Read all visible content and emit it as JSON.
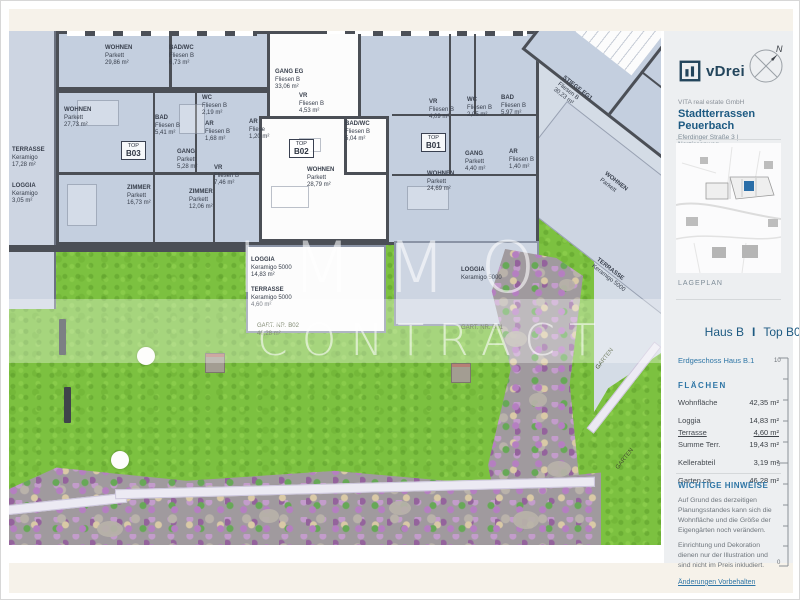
{
  "theme": {
    "accent": "#2f76a6",
    "title_blue": "#1d5a82",
    "wall": "#4b4f56",
    "room_fill": "#c4cfdf",
    "lawn_green": "#7cc140",
    "highlight_blue": "#2a6ea8"
  },
  "watermark": {
    "line1": "IMMO",
    "line2": "CONTRACT"
  },
  "sidebar": {
    "logo_text": "vDrei",
    "compass_letter": "N",
    "company": "VITA real estate GmbH",
    "project": "Stadtterrassen Peuerbach",
    "address": "Eferdinger Straße 3 | Narzissenweg",
    "siteplan_label": "LAGEPLAN",
    "unit_title_house": "Haus B",
    "unit_title_sep": "I",
    "unit_title_top": "Top B02",
    "unit_subtitle": "Erdgeschoss Haus B.1",
    "flaechen_title": "FLÄCHEN",
    "flaechen_rows": [
      {
        "label": "Wohnfläche",
        "value": "42,35 m²",
        "cls": "gap-after"
      },
      {
        "label": "Loggia",
        "value": "14,83 m²",
        "cls": ""
      },
      {
        "label": "Terrasse",
        "value": "4,60 m²",
        "cls": "sum-line"
      },
      {
        "label": "Summe Terr.",
        "value": "19,43 m²",
        "cls": "gap-after"
      },
      {
        "label": "Kellerabteil",
        "value": "3,19 m²",
        "cls": "gap-after"
      },
      {
        "label": "Garten ca.",
        "value": "46,28 m²",
        "cls": ""
      }
    ],
    "ruler_labels": {
      "top": "10",
      "mid": "5",
      "bottom": "0"
    },
    "hinweise_title": "WICHTIGE HINWEISE",
    "hinweise": [
      {
        "text": "Auf Grund des derzeitigen Planungsstandes kann sich die Wohnfläche und die Größe der Eigengärten noch verändern."
      },
      {
        "text": "Einrichtung und Dekoration dienen nur der Illustration und sind nicht im Preis inkludiert."
      }
    ],
    "footnote": "Änderungen Vorbehalten"
  },
  "plan": {
    "rooms": [
      {
        "x": 96,
        "y": 14,
        "lines": [
          "WOHNEN",
          "Parkett",
          "29,86 m²"
        ]
      },
      {
        "x": 160,
        "y": 14,
        "lines": [
          "BAD/WC",
          "Fliesen B",
          "6,73 m²"
        ]
      },
      {
        "x": 55,
        "y": 76,
        "lines": [
          "WOHNEN",
          "Parkett",
          "27,73 m²"
        ]
      },
      {
        "x": 146,
        "y": 84,
        "lines": [
          "BAD",
          "Fliesen B",
          "5,41 m²"
        ]
      },
      {
        "x": 193,
        "y": 64,
        "lines": [
          "WC",
          "Fliesen B",
          "2,19 m²"
        ]
      },
      {
        "x": 196,
        "y": 90,
        "lines": [
          "AR",
          "Fliesen B",
          "1,68 m²"
        ]
      },
      {
        "x": 168,
        "y": 118,
        "lines": [
          "GANG",
          "Parkett",
          "5,28 m²"
        ]
      },
      {
        "x": 205,
        "y": 134,
        "lines": [
          "VR",
          "Fliesen B",
          "7,46 m²"
        ]
      },
      {
        "x": 118,
        "y": 154,
        "lines": [
          "ZIMMER",
          "Parkett",
          "16,73 m²"
        ]
      },
      {
        "x": 180,
        "y": 158,
        "lines": [
          "ZIMMER",
          "Parkett",
          "12,06 m²"
        ]
      },
      {
        "x": 266,
        "y": 38,
        "lines": [
          "GANG EG",
          "Fliesen B",
          "33,06 m²"
        ]
      },
      {
        "x": 290,
        "y": 62,
        "lines": [
          "VR",
          "Fliesen B",
          "4,53 m²"
        ]
      },
      {
        "x": 336,
        "y": 90,
        "lines": [
          "BAD/WC",
          "Fliesen B",
          "5,04 m²"
        ]
      },
      {
        "x": 298,
        "y": 136,
        "lines": [
          "WOHNEN",
          "Parkett",
          "28,79 m²"
        ]
      },
      {
        "x": 240,
        "y": 88,
        "lines": [
          "AR",
          "Fliese",
          "1,20 m²"
        ]
      },
      {
        "x": 420,
        "y": 68,
        "lines": [
          "VR",
          "Fliesen B",
          "4,09 m²"
        ]
      },
      {
        "x": 458,
        "y": 66,
        "lines": [
          "WC",
          "Fliesen B",
          "2,05 m²"
        ]
      },
      {
        "x": 492,
        "y": 64,
        "lines": [
          "BAD",
          "Fliesen B",
          "5,97 m²"
        ]
      },
      {
        "x": 456,
        "y": 120,
        "lines": [
          "GANG",
          "Parkett",
          "4,40 m²"
        ]
      },
      {
        "x": 500,
        "y": 118,
        "lines": [
          "AR",
          "Fliesen B",
          "1,40 m²"
        ]
      },
      {
        "x": 418,
        "y": 140,
        "lines": [
          "WOHNEN",
          "Parkett",
          "24,69 m²"
        ]
      },
      {
        "x": 3,
        "y": 116,
        "lines": [
          "TERRASSE",
          "Keramigo",
          "17,28 m²"
        ]
      },
      {
        "x": 3,
        "y": 152,
        "lines": [
          "LOGGIA",
          "Keramigo",
          "3,05 m²"
        ]
      },
      {
        "x": 242,
        "y": 226,
        "lines": [
          "LOGGIA",
          "Keramigo 5000",
          "14,83 m²"
        ]
      },
      {
        "x": 242,
        "y": 256,
        "lines": [
          "TERRASSE",
          "Keramigo 5000",
          "4,60 m²"
        ]
      },
      {
        "x": 452,
        "y": 236,
        "lines": [
          "LOGGIA",
          "Keramigo 5000",
          ""
        ]
      },
      {
        "x": 556,
        "y": 44,
        "rot": 38,
        "lines": [
          "STIEGE EG1",
          "Fliesen B",
          "30,23 m²"
        ]
      },
      {
        "x": 598,
        "y": 140,
        "rot": 38,
        "lines": [
          "WOHNEN",
          "Parkett",
          ""
        ]
      },
      {
        "x": 590,
        "y": 226,
        "rot": 38,
        "lines": [
          "TERRASSE",
          "Keramigo 5000",
          ""
        ]
      }
    ],
    "top_badges": [
      {
        "x": 112,
        "y": 110,
        "t": "TOP",
        "b": "B03"
      },
      {
        "x": 280,
        "y": 108,
        "t": "TOP",
        "b": "B02"
      },
      {
        "x": 412,
        "y": 102,
        "t": "TOP",
        "b": "B01"
      }
    ],
    "garden_labels": [
      {
        "x": 248,
        "y": 292,
        "lines": [
          "GART. NR. B02",
          "46,28 m²",
          ""
        ]
      },
      {
        "x": 452,
        "y": 294,
        "lines": [
          "GART. NR. B01",
          "",
          ""
        ]
      },
      {
        "x": 586,
        "y": 336,
        "rot": -52,
        "lines": [
          "GARTEN",
          "",
          ""
        ]
      },
      {
        "x": 606,
        "y": 436,
        "rot": -52,
        "lines": [
          "GARTEN",
          "",
          ""
        ]
      }
    ],
    "discs": [
      {
        "x": 128,
        "y": 316
      },
      {
        "x": 102,
        "y": 420
      }
    ],
    "plaques": [
      {
        "x": 196,
        "y": 322
      },
      {
        "x": 442,
        "y": 332
      }
    ],
    "posts": [
      {
        "x": 50,
        "y": 288
      },
      {
        "x": 55,
        "y": 356
      }
    ],
    "stones": [
      {
        "x": 496,
        "y": 300,
        "w": 22,
        "h": 16
      },
      {
        "x": 520,
        "y": 362,
        "w": 18,
        "h": 14
      },
      {
        "x": 538,
        "y": 430,
        "w": 24,
        "h": 16
      },
      {
        "x": 88,
        "y": 490,
        "w": 26,
        "h": 16
      },
      {
        "x": 250,
        "y": 478,
        "w": 20,
        "h": 14
      },
      {
        "x": 380,
        "y": 470,
        "w": 22,
        "h": 14
      },
      {
        "x": 504,
        "y": 480,
        "w": 26,
        "h": 18
      },
      {
        "x": 550,
        "y": 248,
        "w": 16,
        "h": 12
      }
    ]
  }
}
